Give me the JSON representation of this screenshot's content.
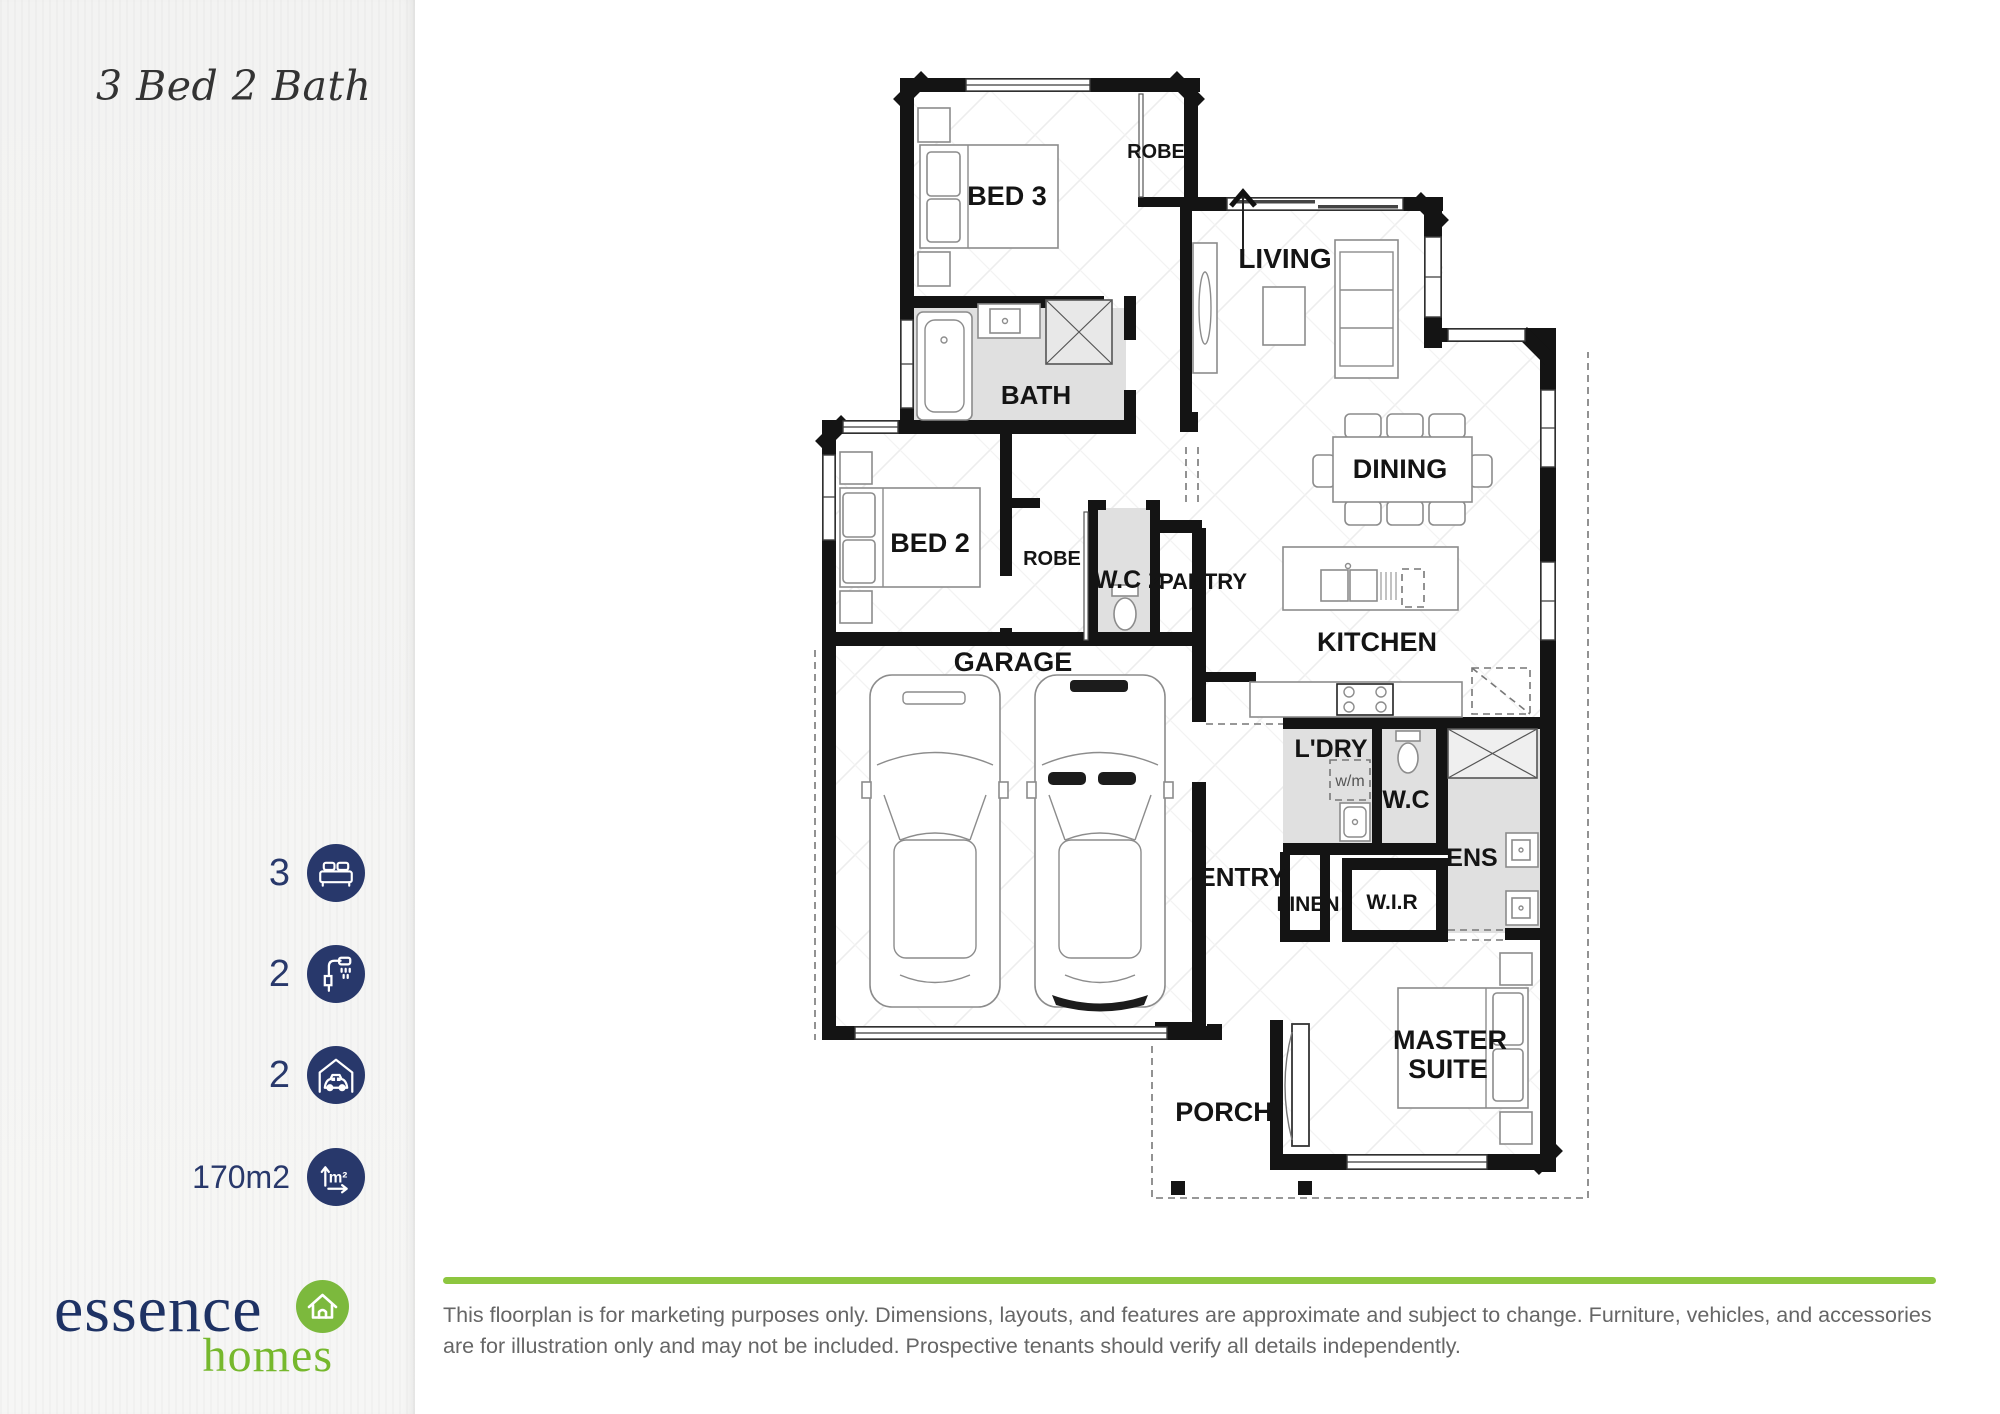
{
  "sidebar": {
    "title": "3 Bed 2 Bath",
    "stats": [
      {
        "value": "3",
        "icon": "bed-icon"
      },
      {
        "value": "2",
        "icon": "bath-icon"
      },
      {
        "value": "2",
        "icon": "car-icon"
      },
      {
        "value": "170m2",
        "icon": "area-icon"
      }
    ],
    "logo": {
      "name": "essence",
      "sub": "homes"
    }
  },
  "floorplan": {
    "labels": {
      "bed3": "BED 3",
      "robe1": "ROBE",
      "living": "LIVING",
      "bath": "BATH",
      "bed2": "BED 2",
      "robe2": "ROBE",
      "wc2": "W.C 2",
      "pantry": "PANTRY",
      "dining": "DINING",
      "kitchen": "KITCHEN",
      "garage": "GARAGE",
      "ldry": "L'DRY",
      "wm": "w/m",
      "wc": "W.C",
      "ens": "ENS",
      "entry": "ENTRY",
      "linen": "LINEN",
      "wir": "W.I.R",
      "master_line1": "MASTER",
      "master_line2": "SUITE",
      "porch": "PORCH"
    }
  },
  "icons": {
    "area_label": "m²"
  },
  "footer": {
    "disclaimer": "This floorplan is for marketing purposes only. Dimensions, layouts, and features are approximate and subject to change. Furniture, vehicles, and accessories are for illustration only and may not be included. Prospective tenants should verify all details independently."
  },
  "colors": {
    "navy": "#28386b",
    "green": "#8dc63f",
    "logo_navy": "#1e3264",
    "logo_green": "#76b82d"
  }
}
